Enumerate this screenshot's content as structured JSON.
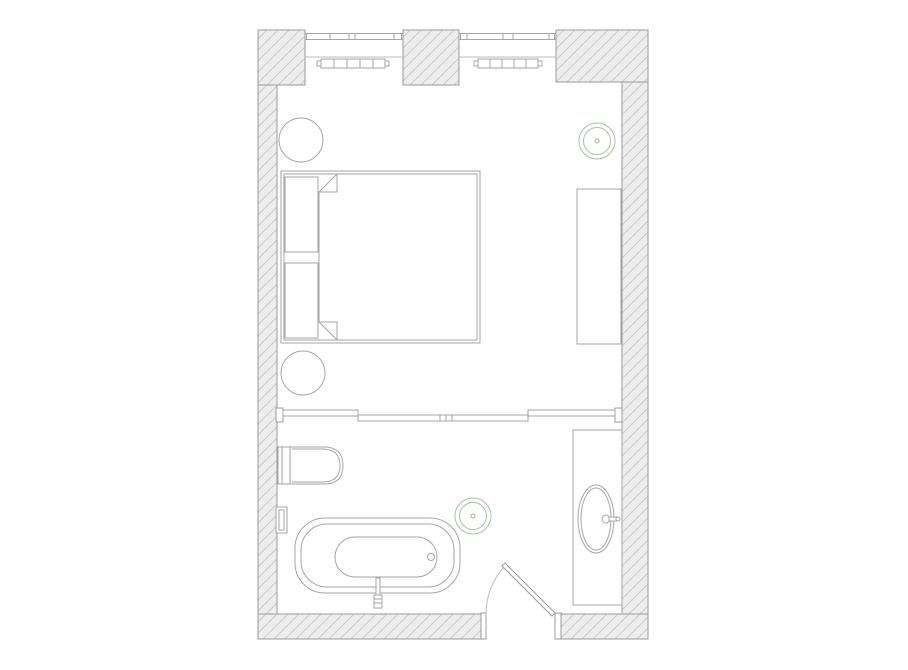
{
  "meta": {
    "type": "architectural-floor-plan",
    "rooms": [
      "bedroom",
      "bathroom"
    ],
    "canvas": {
      "w": 908,
      "h": 670
    },
    "colors": {
      "background": "#ffffff",
      "wall_fill": "#ededed",
      "hatch_line": "#c6c6c6",
      "wall_stroke": "#9b9b9b",
      "furniture_stroke": "#a6a6a6",
      "thin_stroke": "#bdbdbd",
      "accent_green": "#a6c4a6",
      "accent_green_dot": "#9bb39b"
    }
  },
  "styles": {
    "wall": {
      "fill": "hatch",
      "stroke": "#9b9b9b",
      "sw": 1
    },
    "fw": {
      "fill": "#ffffff",
      "stroke": "#a6a6a6",
      "sw": 1
    },
    "fwd": {
      "fill": "#ffffff",
      "stroke": "#9b9b9b",
      "sw": 1
    },
    "ln": {
      "fill": "none",
      "stroke": "#a6a6a6",
      "sw": 1
    },
    "thin": {
      "fill": "none",
      "stroke": "#bdbdbd",
      "sw": 1
    },
    "green": {
      "fill": "none",
      "stroke": "#a6c4a6",
      "sw": 1
    },
    "gdot": {
      "fill": "none",
      "stroke": "#9bb39b",
      "sw": 1
    }
  },
  "plan": {
    "elements": [
      {
        "name": "wall-pier-top-left",
        "interactable": false,
        "shapes": [
          {
            "t": "rect",
            "x": 258,
            "y": 30,
            "w": 47,
            "h": 55,
            "s": "wall"
          }
        ]
      },
      {
        "name": "wall-pier-top-center",
        "interactable": false,
        "shapes": [
          {
            "t": "rect",
            "x": 403,
            "y": 30,
            "w": 56,
            "h": 55,
            "s": "wall"
          }
        ]
      },
      {
        "name": "wall-pier-top-right",
        "interactable": false,
        "shapes": [
          {
            "t": "rect",
            "x": 556,
            "y": 30,
            "w": 92,
            "h": 52,
            "s": "wall"
          }
        ]
      },
      {
        "name": "wall-left",
        "interactable": false,
        "shapes": [
          {
            "t": "rect",
            "x": 258,
            "y": 85,
            "w": 19,
            "h": 554,
            "s": "wall"
          }
        ]
      },
      {
        "name": "wall-right",
        "interactable": false,
        "shapes": [
          {
            "t": "rect",
            "x": 622,
            "y": 82,
            "w": 26,
            "h": 557,
            "s": "wall"
          }
        ]
      },
      {
        "name": "wall-bottom-left",
        "interactable": false,
        "shapes": [
          {
            "t": "rect",
            "x": 258,
            "y": 614,
            "w": 223,
            "h": 25,
            "s": "wall"
          }
        ]
      },
      {
        "name": "wall-bottom-right",
        "interactable": false,
        "shapes": [
          {
            "t": "rect",
            "x": 561,
            "y": 614,
            "w": 87,
            "h": 25,
            "s": "wall"
          }
        ]
      },
      {
        "name": "window-left",
        "interactable": false,
        "shapes": [
          {
            "t": "line",
            "x1": 305,
            "y1": 33.5,
            "x2": 403,
            "y2": 33.5,
            "s": "ln"
          },
          {
            "t": "line",
            "x1": 305,
            "y1": 39.5,
            "x2": 403,
            "y2": 39.5,
            "s": "ln"
          },
          {
            "t": "line",
            "n": "mullion",
            "x1": 306.5,
            "y1": 33.5,
            "x2": 306.5,
            "y2": 39.5,
            "s": "ln"
          },
          {
            "t": "line",
            "n": "mullion",
            "x1": 330,
            "y1": 33.5,
            "x2": 330,
            "y2": 39.5,
            "s": "ln"
          },
          {
            "t": "line",
            "n": "mullion",
            "x1": 349,
            "y1": 33.5,
            "x2": 349,
            "y2": 39.5,
            "s": "ln"
          },
          {
            "t": "line",
            "n": "mullion",
            "x1": 355,
            "y1": 33.5,
            "x2": 355,
            "y2": 39.5,
            "s": "ln"
          },
          {
            "t": "line",
            "n": "mullion",
            "x1": 394,
            "y1": 33.5,
            "x2": 394,
            "y2": 39.5,
            "s": "ln"
          },
          {
            "t": "line",
            "n": "mullion",
            "x1": 401.5,
            "y1": 33.5,
            "x2": 401.5,
            "y2": 39.5,
            "s": "ln"
          },
          {
            "t": "line",
            "n": "window-sill-line",
            "x1": 305,
            "y1": 57,
            "x2": 403,
            "y2": 57,
            "s": "thin"
          }
        ]
      },
      {
        "name": "window-right",
        "interactable": false,
        "shapes": [
          {
            "t": "line",
            "x1": 459,
            "y1": 33.5,
            "x2": 556,
            "y2": 33.5,
            "s": "ln"
          },
          {
            "t": "line",
            "x1": 459,
            "y1": 39.5,
            "x2": 556,
            "y2": 39.5,
            "s": "ln"
          },
          {
            "t": "line",
            "n": "mullion",
            "x1": 460.5,
            "y1": 33.5,
            "x2": 460.5,
            "y2": 39.5,
            "s": "ln"
          },
          {
            "t": "line",
            "n": "mullion",
            "x1": 467,
            "y1": 33.5,
            "x2": 467,
            "y2": 39.5,
            "s": "ln"
          },
          {
            "t": "line",
            "n": "mullion",
            "x1": 503,
            "y1": 33.5,
            "x2": 503,
            "y2": 39.5,
            "s": "ln"
          },
          {
            "t": "line",
            "n": "mullion",
            "x1": 513,
            "y1": 33.5,
            "x2": 513,
            "y2": 39.5,
            "s": "ln"
          },
          {
            "t": "line",
            "n": "mullion",
            "x1": 549,
            "y1": 33.5,
            "x2": 549,
            "y2": 39.5,
            "s": "ln"
          },
          {
            "t": "line",
            "n": "mullion",
            "x1": 554.5,
            "y1": 33.5,
            "x2": 554.5,
            "y2": 39.5,
            "s": "ln"
          },
          {
            "t": "line",
            "n": "window-sill-line",
            "x1": 459,
            "y1": 57,
            "x2": 556,
            "y2": 57,
            "s": "thin"
          }
        ]
      },
      {
        "name": "radiator-left",
        "interactable": false,
        "shapes": [
          {
            "t": "rect",
            "n": "radiator-end-tab",
            "x": 317,
            "y": 61,
            "w": 4,
            "h": 5,
            "s": "fw"
          },
          {
            "t": "rect",
            "n": "radiator-end-tab",
            "x": 385,
            "y": 61,
            "w": 4,
            "h": 5,
            "s": "fw"
          },
          {
            "t": "rect",
            "x": 321,
            "y": 59,
            "w": 64,
            "h": 9,
            "s": "fw"
          },
          {
            "t": "line",
            "x1": 334,
            "y1": 59,
            "x2": 334,
            "y2": 68,
            "s": "ln"
          },
          {
            "t": "line",
            "x1": 347,
            "y1": 59,
            "x2": 347,
            "y2": 68,
            "s": "ln"
          },
          {
            "t": "line",
            "x1": 360,
            "y1": 59,
            "x2": 360,
            "y2": 68,
            "s": "ln"
          },
          {
            "t": "line",
            "x1": 373,
            "y1": 59,
            "x2": 373,
            "y2": 68,
            "s": "ln"
          }
        ]
      },
      {
        "name": "radiator-right",
        "interactable": false,
        "shapes": [
          {
            "t": "rect",
            "n": "radiator-end-tab",
            "x": 474,
            "y": 61,
            "w": 4,
            "h": 5,
            "s": "fw"
          },
          {
            "t": "rect",
            "n": "radiator-end-tab",
            "x": 538,
            "y": 61,
            "w": 4,
            "h": 5,
            "s": "fw"
          },
          {
            "t": "rect",
            "x": 478,
            "y": 59,
            "w": 60,
            "h": 9,
            "s": "fw"
          },
          {
            "t": "line",
            "x1": 490,
            "y1": 59,
            "x2": 490,
            "y2": 68,
            "s": "ln"
          },
          {
            "t": "line",
            "x1": 502,
            "y1": 59,
            "x2": 502,
            "y2": 68,
            "s": "ln"
          },
          {
            "t": "line",
            "x1": 514,
            "y1": 59,
            "x2": 514,
            "y2": 68,
            "s": "ln"
          },
          {
            "t": "line",
            "x1": 526,
            "y1": 59,
            "x2": 526,
            "y2": 68,
            "s": "ln"
          }
        ]
      },
      {
        "name": "round-side-table-upper",
        "interactable": false,
        "shapes": [
          {
            "t": "circle",
            "cx": 301,
            "cy": 140,
            "r": 22,
            "s": "fw"
          }
        ]
      },
      {
        "name": "round-side-table-lower",
        "interactable": false,
        "shapes": [
          {
            "t": "circle",
            "cx": 303,
            "cy": 373,
            "r": 22,
            "s": "fw"
          }
        ]
      },
      {
        "name": "ceiling-light-bedroom",
        "interactable": false,
        "shapes": [
          {
            "t": "circle",
            "cx": 597,
            "cy": 141,
            "r": 18,
            "s": "green"
          },
          {
            "t": "circle",
            "cx": 597,
            "cy": 141,
            "r": 13.5,
            "s": "green"
          },
          {
            "t": "circle",
            "n": "center-dot",
            "cx": 597,
            "cy": 141,
            "r": 2,
            "s": "gdot"
          }
        ]
      },
      {
        "name": "bed-frame",
        "interactable": false,
        "shapes": [
          {
            "t": "rect",
            "x": 281,
            "y": 171,
            "w": 199,
            "h": 172,
            "s": "fw"
          },
          {
            "t": "rect",
            "x": 284,
            "y": 174,
            "w": 193,
            "h": 166,
            "s": "ln"
          }
        ]
      },
      {
        "name": "bed-pillow-upper",
        "interactable": false,
        "shapes": [
          {
            "t": "rect",
            "x": 285,
            "y": 177,
            "w": 33,
            "h": 75,
            "s": "fw"
          }
        ]
      },
      {
        "name": "bed-pillow-lower",
        "interactable": false,
        "shapes": [
          {
            "t": "rect",
            "x": 285,
            "y": 263,
            "w": 33,
            "h": 75,
            "s": "fw"
          }
        ]
      },
      {
        "name": "bed-duvet",
        "interactable": false,
        "shapes": [
          {
            "t": "path",
            "d": "M337,174 H477 V340 H337 L319,322 V192 Z",
            "s": "fw"
          },
          {
            "t": "path",
            "n": "duvet-fold-top",
            "d": "M337,174 V192 H319",
            "s": "ln"
          },
          {
            "t": "path",
            "n": "duvet-fold-bottom",
            "d": "M337,340 V322 H319",
            "s": "ln"
          }
        ]
      },
      {
        "name": "dresser-console",
        "interactable": false,
        "shapes": [
          {
            "t": "rect",
            "x": 577,
            "y": 189,
            "w": 44,
            "h": 155,
            "s": "fw"
          }
        ]
      },
      {
        "name": "sliding-glass-partition",
        "interactable": false,
        "shapes": [
          {
            "t": "rect",
            "n": "partition-bracket-left",
            "x": 276,
            "y": 408,
            "w": 7,
            "h": 14,
            "s": "fwd"
          },
          {
            "t": "rect",
            "n": "partition-bracket-right",
            "x": 615,
            "y": 408,
            "w": 7,
            "h": 14,
            "s": "fwd"
          },
          {
            "t": "rect",
            "n": "partition-panel",
            "x": 358,
            "y": 415,
            "w": 82,
            "h": 6,
            "s": "fw"
          },
          {
            "t": "rect",
            "n": "partition-panel",
            "x": 440,
            "y": 415,
            "w": 88,
            "h": 6,
            "s": "fw"
          },
          {
            "t": "line",
            "n": "panel-joint",
            "x1": 446,
            "y1": 415,
            "x2": 446,
            "y2": 421,
            "s": "ln"
          },
          {
            "t": "line",
            "n": "panel-joint",
            "x1": 452,
            "y1": 415,
            "x2": 452,
            "y2": 421,
            "s": "ln"
          },
          {
            "t": "rect",
            "n": "partition-panel",
            "x": 283,
            "y": 410,
            "w": 75,
            "h": 6,
            "s": "fw"
          },
          {
            "t": "rect",
            "n": "partition-panel",
            "x": 528,
            "y": 410,
            "w": 87,
            "h": 6,
            "s": "fw"
          }
        ]
      },
      {
        "name": "toilet",
        "interactable": false,
        "shapes": [
          {
            "t": "rect",
            "n": "toilet-tank",
            "x": 278,
            "y": 447,
            "w": 12,
            "h": 37,
            "s": "fw"
          },
          {
            "t": "line",
            "x1": 282,
            "y1": 447,
            "x2": 282,
            "y2": 484,
            "s": "ln"
          },
          {
            "t": "path",
            "n": "toilet-bowl",
            "d": "M290,447 H324 Q343,447 343,465.5 Q343,484 324,484 H290 Z",
            "s": "fw"
          },
          {
            "t": "path",
            "n": "toilet-bowl-inner",
            "d": "M292,449 H322 Q340,449 340,465.5 Q340,482 322,482 H292",
            "s": "ln"
          }
        ]
      },
      {
        "name": "wall-niche",
        "interactable": false,
        "shapes": [
          {
            "t": "rect",
            "x": 276,
            "y": 507,
            "w": 11,
            "h": 26,
            "s": "fw"
          },
          {
            "t": "rect",
            "x": 279,
            "y": 510,
            "w": 5,
            "h": 20,
            "s": "ln"
          }
        ]
      },
      {
        "name": "bathtub",
        "interactable": false,
        "shapes": [
          {
            "t": "rect",
            "n": "tub-outer",
            "x": 295,
            "y": 518,
            "w": 165,
            "h": 75,
            "rx": 30,
            "s": "fw"
          },
          {
            "t": "rect",
            "n": "tub-rim",
            "x": 301,
            "y": 524,
            "w": 153,
            "h": 63,
            "rx": 26,
            "s": "ln"
          },
          {
            "t": "rect",
            "n": "tub-basin",
            "x": 335,
            "y": 537,
            "w": 102,
            "h": 40,
            "rx": 20,
            "s": "ln"
          },
          {
            "t": "circle",
            "n": "tub-drain",
            "cx": 431,
            "cy": 557,
            "r": 3.5,
            "s": "ln"
          }
        ]
      },
      {
        "name": "tub-filler-faucet",
        "interactable": false,
        "shapes": [
          {
            "t": "rect",
            "n": "faucet-stem",
            "x": 376,
            "y": 578,
            "w": 4,
            "h": 18,
            "s": "fw"
          },
          {
            "t": "rect",
            "n": "faucet-handle",
            "x": 374,
            "y": 595,
            "w": 8,
            "h": 13,
            "s": "fw"
          },
          {
            "t": "line",
            "x1": 374,
            "y1": 599,
            "x2": 382,
            "y2": 599,
            "s": "ln"
          },
          {
            "t": "line",
            "x1": 374,
            "y1": 603,
            "x2": 382,
            "y2": 603,
            "s": "ln"
          }
        ]
      },
      {
        "name": "ceiling-light-bathroom",
        "interactable": false,
        "shapes": [
          {
            "t": "circle",
            "cx": 473,
            "cy": 516,
            "r": 18,
            "s": "green"
          },
          {
            "t": "circle",
            "cx": 473,
            "cy": 516,
            "r": 13.5,
            "s": "green"
          },
          {
            "t": "circle",
            "n": "center-dot",
            "cx": 473,
            "cy": 516,
            "r": 2,
            "s": "gdot"
          }
        ]
      },
      {
        "name": "vanity-counter",
        "interactable": false,
        "shapes": [
          {
            "t": "rect",
            "x": 573,
            "y": 430,
            "w": 49,
            "h": 175,
            "s": "fw"
          }
        ]
      },
      {
        "name": "sink-basin",
        "interactable": false,
        "shapes": [
          {
            "t": "ellipse",
            "cx": 596,
            "cy": 519,
            "rx": 18,
            "ry": 34,
            "s": "fw"
          },
          {
            "t": "ellipse",
            "cx": 596,
            "cy": 519,
            "rx": 15,
            "ry": 31,
            "s": "ln"
          }
        ]
      },
      {
        "name": "sink-faucet",
        "interactable": false,
        "shapes": [
          {
            "t": "circle",
            "cx": 606,
            "cy": 519,
            "r": 4,
            "s": "fw"
          },
          {
            "t": "rect",
            "x": 609,
            "y": 517,
            "w": 8,
            "h": 4,
            "s": "fw"
          },
          {
            "t": "circle",
            "cx": 618,
            "cy": 519,
            "r": 2,
            "s": "fw"
          }
        ]
      },
      {
        "name": "bathroom-door",
        "interactable": false,
        "shapes": [
          {
            "t": "rect",
            "n": "door-jamb-left",
            "x": 481,
            "y": 613,
            "w": 5,
            "h": 26,
            "s": "fwd"
          },
          {
            "t": "rect",
            "n": "door-jamb-right",
            "x": 555,
            "y": 613,
            "w": 6,
            "h": 26,
            "s": "fwd"
          },
          {
            "t": "path",
            "n": "door-swing-arc",
            "d": "M486,614 A69,69 0 0 1 506,565",
            "s": "thin"
          },
          {
            "t": "polygon",
            "n": "door-leaf",
            "points": "555,613 505,563 502,566 552,616",
            "s": "fwd"
          }
        ]
      }
    ]
  }
}
